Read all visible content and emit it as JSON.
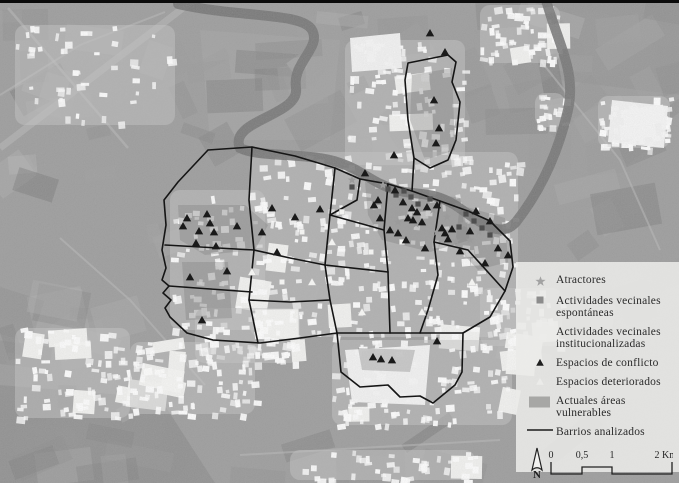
{
  "figure": {
    "type": "grayscale-aerial-city-map"
  },
  "legend": {
    "items": [
      {
        "symbol": "star",
        "line1": "Atractores",
        "line2": ""
      },
      {
        "symbol": "square",
        "line1": "Actividades vecinales",
        "line2": "espontáneas"
      },
      {
        "symbol": "square-light",
        "line1": "Actividades vecinales",
        "line2": "institucionalizadas"
      },
      {
        "symbol": "triangle",
        "line1": "Espacios de conflicto",
        "line2": ""
      },
      {
        "symbol": "triangle-light",
        "line1": "Espacios deteriorados",
        "line2": ""
      },
      {
        "symbol": "area",
        "line1": "Actuales áreas",
        "line2": "vulnerables"
      },
      {
        "symbol": "line",
        "line1": "Barrios analizados",
        "line2": ""
      }
    ],
    "scale_bar": {
      "tick_labels": [
        "0",
        "0,5",
        "1",
        "2 Km"
      ]
    },
    "north_label": "N"
  },
  "colors": {
    "legend_bg": "rgba(234,234,232,0.88)",
    "boundary": "#151515",
    "triangle": "#1a1a1a",
    "square": "#4f4f4f",
    "star": "#9b9b9b",
    "light_symbol": "#f2f2f0",
    "vulnerable": "#7f7f7f",
    "river": "#737373"
  },
  "map": {
    "river_path": "M545,-4 C556,40 577,70 568,110 C560,145 545,185 516,222 C500,240 480,222 455,205 C430,190 415,196 396,190 C370,182 362,170 340,163 C310,152 260,158 240,148 C228,120 300,116 296,88 C292,62 322,48 312,30 C302,12 240,18 178,4",
    "boundaries": [
      [
        [
          208,
          150
        ],
        [
          252,
          147
        ],
        [
          295,
          156
        ],
        [
          335,
          168
        ],
        [
          360,
          179
        ],
        [
          388,
          184
        ],
        [
          412,
          191
        ],
        [
          440,
          201
        ],
        [
          468,
          211
        ],
        [
          490,
          221
        ],
        [
          510,
          241
        ],
        [
          513,
          267
        ],
        [
          505,
          291
        ],
        [
          490,
          317
        ],
        [
          463,
          333
        ],
        [
          462,
          372
        ],
        [
          455,
          385
        ],
        [
          433,
          403
        ],
        [
          420,
          396
        ],
        [
          400,
          397
        ],
        [
          388,
          385
        ],
        [
          360,
          387
        ],
        [
          341,
          372
        ],
        [
          337,
          333
        ],
        [
          300,
          338
        ],
        [
          260,
          343
        ],
        [
          213,
          340
        ],
        [
          187,
          333
        ],
        [
          170,
          317
        ],
        [
          165,
          308
        ],
        [
          171,
          300
        ],
        [
          163,
          293
        ],
        [
          169,
          286
        ],
        [
          162,
          280
        ],
        [
          166,
          268
        ],
        [
          162,
          250
        ],
        [
          166,
          225
        ],
        [
          164,
          200
        ],
        [
          178,
          182
        ],
        [
          208,
          150
        ]
      ],
      [
        [
          412,
          191
        ],
        [
          414,
          158
        ],
        [
          408,
          120
        ],
        [
          405,
          80
        ],
        [
          408,
          63
        ],
        [
          448,
          55
        ],
        [
          456,
          62
        ],
        [
          452,
          82
        ],
        [
          460,
          102
        ],
        [
          456,
          140
        ],
        [
          448,
          160
        ],
        [
          430,
          168
        ],
        [
          414,
          158
        ]
      ],
      [
        [
          252,
          147
        ],
        [
          249,
          200
        ],
        [
          254,
          250
        ],
        [
          249,
          300
        ],
        [
          258,
          343
        ]
      ],
      [
        [
          335,
          168
        ],
        [
          330,
          215
        ],
        [
          325,
          265
        ],
        [
          330,
          300
        ],
        [
          337,
          333
        ]
      ],
      [
        [
          388,
          184
        ],
        [
          384,
          230
        ],
        [
          388,
          272
        ],
        [
          390,
          333
        ]
      ],
      [
        [
          337,
          333
        ],
        [
          390,
          333
        ],
        [
          463,
          333
        ]
      ],
      [
        [
          165,
          245
        ],
        [
          254,
          250
        ]
      ],
      [
        [
          169,
          286
        ],
        [
          252,
          292
        ]
      ],
      [
        [
          325,
          265
        ],
        [
          388,
          272
        ]
      ],
      [
        [
          330,
          215
        ],
        [
          384,
          230
        ]
      ],
      [
        [
          440,
          201
        ],
        [
          434,
          242
        ],
        [
          438,
          275
        ],
        [
          428,
          310
        ],
        [
          420,
          333
        ]
      ],
      [
        [
          434,
          242
        ],
        [
          468,
          250
        ],
        [
          505,
          291
        ]
      ],
      [
        [
          254,
          250
        ],
        [
          290,
          258
        ],
        [
          325,
          265
        ]
      ],
      [
        [
          249,
          300
        ],
        [
          290,
          302
        ],
        [
          330,
          300
        ]
      ],
      [
        [
          360,
          179
        ],
        [
          357,
          200
        ],
        [
          330,
          215
        ]
      ]
    ],
    "vulnerable_areas": [
      [
        [
          178,
          205
        ],
        [
          245,
          205
        ],
        [
          268,
          225
        ],
        [
          255,
          250
        ],
        [
          205,
          255
        ],
        [
          180,
          240
        ]
      ],
      [
        [
          365,
          182
        ],
        [
          460,
          198
        ],
        [
          470,
          240
        ],
        [
          430,
          252
        ],
        [
          382,
          240
        ],
        [
          368,
          215
        ]
      ],
      [
        [
          460,
          205
        ],
        [
          505,
          218
        ],
        [
          508,
          262
        ],
        [
          478,
          270
        ],
        [
          455,
          245
        ]
      ],
      [
        [
          412,
          75
        ],
        [
          452,
          68
        ],
        [
          455,
          150
        ],
        [
          425,
          160
        ],
        [
          410,
          120
        ]
      ],
      [
        [
          358,
          348
        ],
        [
          415,
          350
        ],
        [
          410,
          372
        ],
        [
          362,
          370
        ]
      ],
      [
        [
          182,
          262
        ],
        [
          228,
          262
        ],
        [
          232,
          318
        ],
        [
          186,
          320
        ]
      ]
    ],
    "markers": {
      "triangles": [
        [
          187,
          218
        ],
        [
          207,
          214
        ],
        [
          210,
          223
        ],
        [
          199,
          231
        ],
        [
          214,
          232
        ],
        [
          183,
          226
        ],
        [
          196,
          243
        ],
        [
          216,
          246
        ],
        [
          237,
          226
        ],
        [
          262,
          232
        ],
        [
          190,
          277
        ],
        [
          227,
          271
        ],
        [
          202,
          320
        ],
        [
          277,
          252
        ],
        [
          295,
          217
        ],
        [
          272,
          208
        ],
        [
          320,
          209
        ],
        [
          430,
          33
        ],
        [
          445,
          52
        ],
        [
          434,
          100
        ],
        [
          439,
          128
        ],
        [
          436,
          143
        ],
        [
          394,
          155
        ],
        [
          365,
          173
        ],
        [
          395,
          190
        ],
        [
          378,
          200
        ],
        [
          403,
          202
        ],
        [
          412,
          208
        ],
        [
          417,
          212
        ],
        [
          408,
          218
        ],
        [
          427,
          207
        ],
        [
          437,
          205
        ],
        [
          413,
          220
        ],
        [
          422,
          222
        ],
        [
          442,
          228
        ],
        [
          374,
          205
        ],
        [
          380,
          218
        ],
        [
          390,
          230
        ],
        [
          398,
          233
        ],
        [
          406,
          240
        ],
        [
          425,
          248
        ],
        [
          448,
          239
        ],
        [
          460,
          251
        ],
        [
          470,
          231
        ],
        [
          452,
          229
        ],
        [
          476,
          211
        ],
        [
          490,
          221
        ],
        [
          498,
          248
        ],
        [
          485,
          263
        ],
        [
          445,
          233
        ],
        [
          508,
          255
        ],
        [
          373,
          357
        ],
        [
          381,
          359
        ],
        [
          392,
          360
        ],
        [
          437,
          341
        ]
      ],
      "squares": [
        [
          388,
          189
        ],
        [
          396,
          195
        ],
        [
          404,
          191
        ],
        [
          411,
          197
        ],
        [
          466,
          214
        ],
        [
          474,
          221
        ],
        [
          482,
          228
        ],
        [
          459,
          227
        ],
        [
          352,
          187
        ],
        [
          418,
          204
        ],
        [
          430,
          199
        ],
        [
          490,
          235
        ]
      ],
      "stars": [
        [
          383,
          185
        ],
        [
          401,
          200
        ],
        [
          433,
          210
        ],
        [
          447,
          217
        ],
        [
          464,
          224
        ],
        [
          479,
          232
        ],
        [
          416,
          224
        ],
        [
          437,
          232
        ],
        [
          456,
          241
        ],
        [
          352,
          180
        ],
        [
          398,
          222
        ],
        [
          470,
          240
        ]
      ],
      "light_squares": [
        [
          302,
          232
        ],
        [
          342,
          212
        ],
        [
          371,
          252
        ],
        [
          432,
          262
        ],
        [
          282,
          282
        ],
        [
          402,
          242
        ]
      ],
      "light_triangles": [
        [
          252,
          272
        ],
        [
          312,
          282
        ],
        [
          362,
          312
        ],
        [
          422,
          312
        ],
        [
          332,
          242
        ],
        [
          472,
          282
        ]
      ]
    }
  }
}
